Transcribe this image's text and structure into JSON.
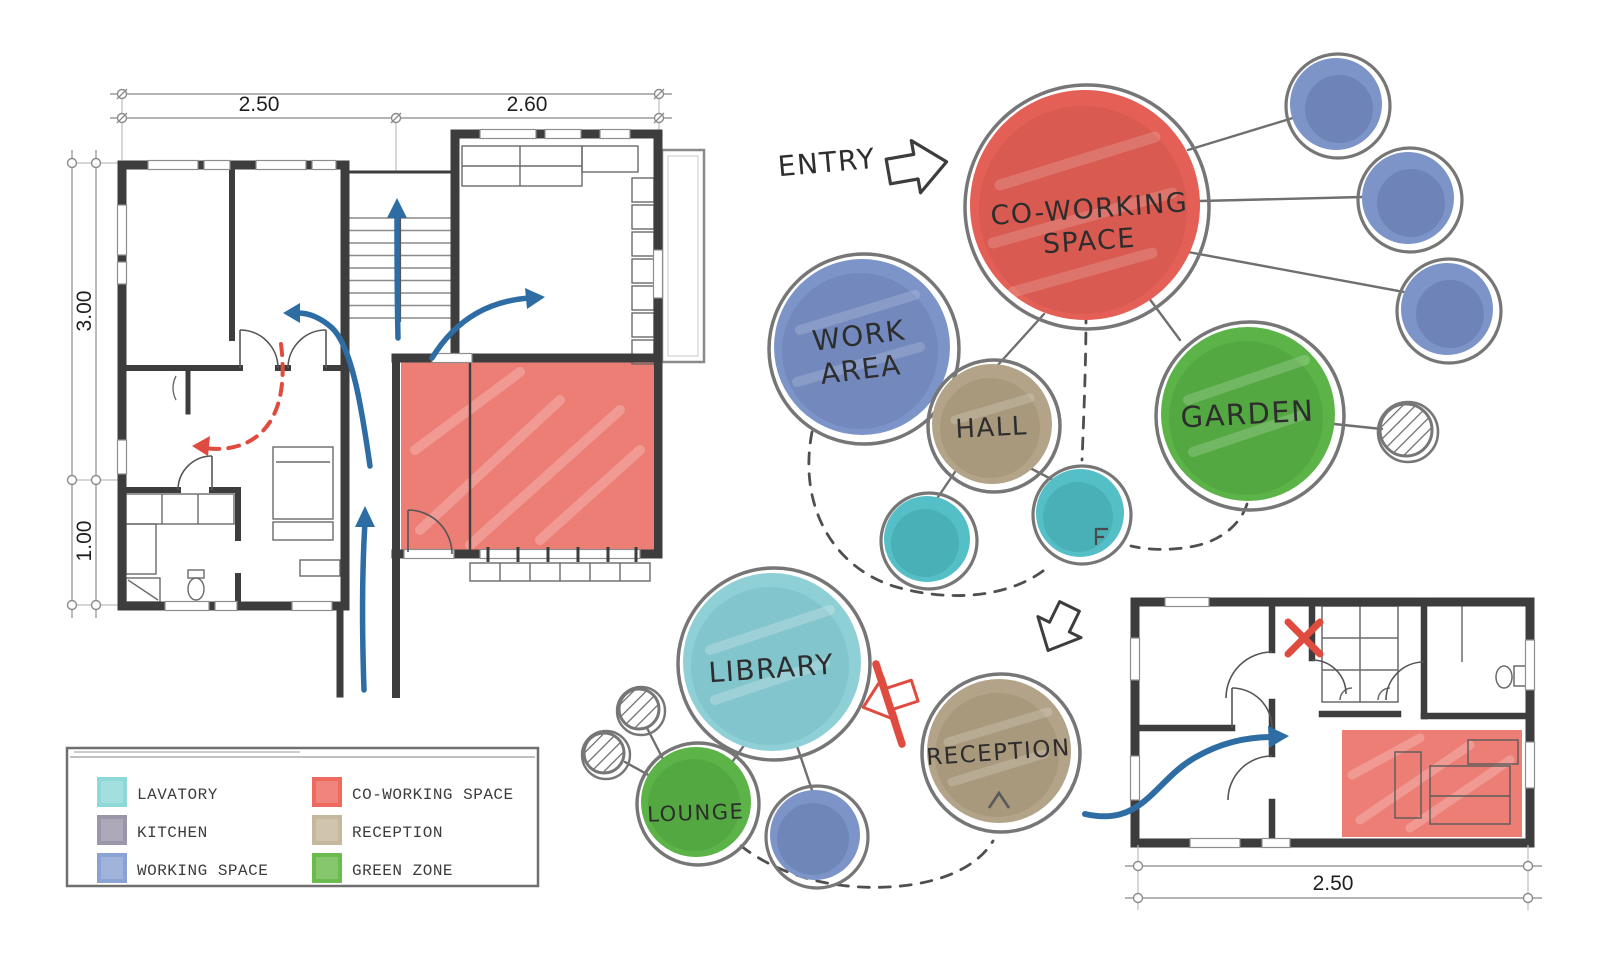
{
  "colors": {
    "wall": "#3d3d3d",
    "flow_arrow_blue": "#2e6da4",
    "annotation_red": "#df4b3e",
    "zone_red": "#e8655a",
    "connector_gray": "#6f6f6f",
    "dashed_gray": "#4f4f4f",
    "sketch_ring": "#767676"
  },
  "entry": {
    "label": "ENTRY"
  },
  "bubbles": {
    "coworking": {
      "line1": "CO-WORKING",
      "line2": "SPACE",
      "color": "#e45f55"
    },
    "work_area": {
      "line1": "WORK",
      "line2": "AREA",
      "color": "#7d94c8"
    },
    "hall": {
      "label": "HALL",
      "color": "#b3a489"
    },
    "garden": {
      "label": "GARDEN",
      "color": "#5cb347"
    },
    "library": {
      "label": "LIBRARY",
      "color": "#8ed0d6"
    },
    "lounge": {
      "label": "LOUNGE",
      "color": "#5cb347"
    },
    "reception": {
      "label": "RECEPTION",
      "color": "#b3a489"
    },
    "support_colors": {
      "lavatory": "#55bfc7",
      "working_space": "#7d94c8"
    }
  },
  "plans": {
    "upper": {
      "dim_top_left": "2.50",
      "dim_top_right": "2.60",
      "dim_left_upper": "3.00",
      "dim_left_lower": "1.00"
    },
    "lower": {
      "dim_bottom": "2.50"
    }
  },
  "legend": {
    "left": [
      {
        "label": "LAVATORY",
        "color": "#8fd8d8"
      },
      {
        "label": "KITCHEN",
        "color": "#9b96a9"
      },
      {
        "label": "WORKING SPACE",
        "color": "#8ba3d4"
      }
    ],
    "right": [
      {
        "label": "CO-WORKING SPACE",
        "color": "#ee6a5f"
      },
      {
        "label": "RECEPTION",
        "color": "#c6b89d"
      },
      {
        "label": "GREEN ZONE",
        "color": "#6cbb4e"
      }
    ]
  }
}
